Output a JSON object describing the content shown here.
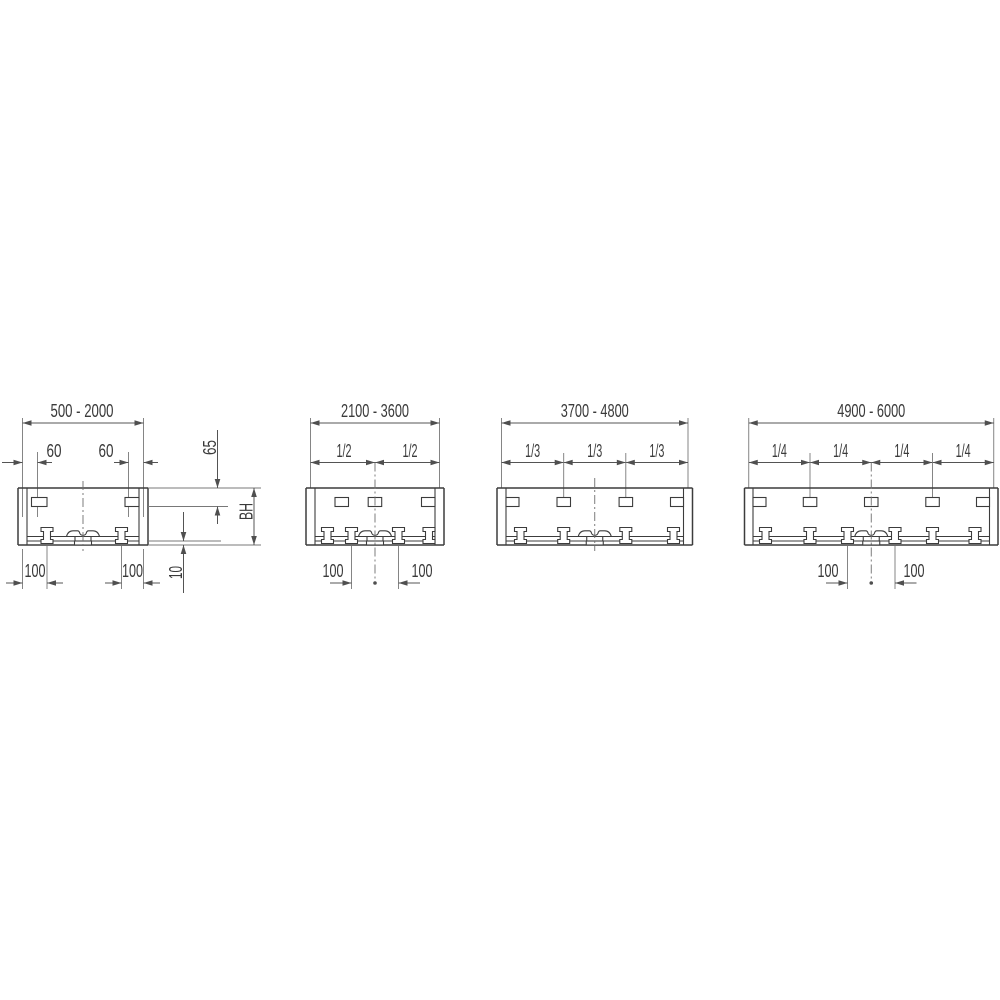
{
  "colors": {
    "part_line": "#3c3c3c",
    "dimension_line": "#545454",
    "text": "#3a3a3a",
    "background": "#ffffff"
  },
  "diagrams": [
    {
      "range": "500 - 2000",
      "dims": {
        "clip_offsets": [
          "60",
          "60"
        ],
        "clip_depth": "65",
        "profile_height": "BH",
        "rail_offset": "10",
        "bracket_offsets": [
          "100",
          "100"
        ]
      }
    },
    {
      "range": "2100 - 3600",
      "dims": {
        "fractions": [
          "1/2",
          "1/2"
        ],
        "bracket_offsets": [
          "100",
          "100"
        ]
      }
    },
    {
      "range": "3700 - 4800",
      "dims": {
        "fractions": [
          "1/3",
          "1/3",
          "1/3"
        ]
      }
    },
    {
      "range": "4900 - 6000",
      "dims": {
        "fractions": [
          "1/4",
          "1/4",
          "1/4",
          "1/4"
        ],
        "bracket_offsets": [
          "100",
          "100"
        ]
      }
    }
  ]
}
